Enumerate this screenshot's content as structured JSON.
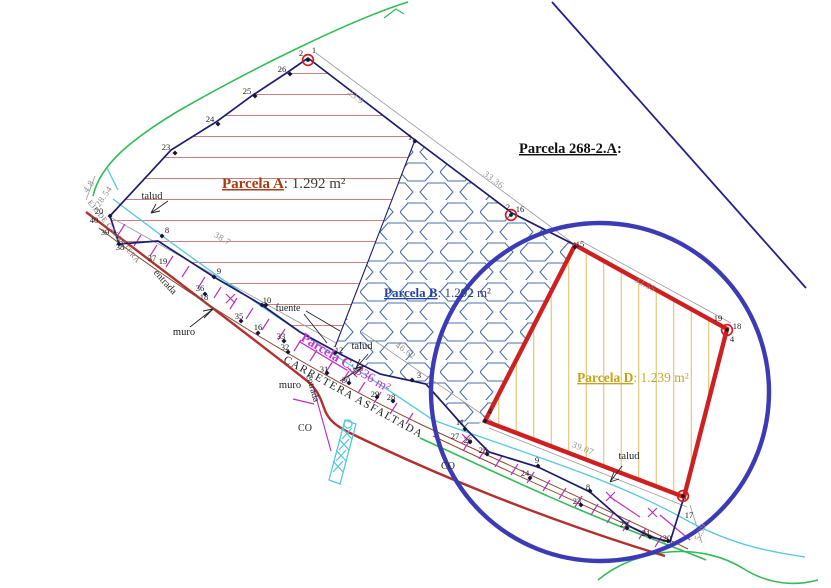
{
  "title": {
    "text": "Parcela 268-2.A",
    "colon": ":"
  },
  "parcels": [
    {
      "label": "Parcela A",
      "sep": ": ",
      "value": "1.292 m²",
      "color": "#a63c14",
      "value_color": "#3a3a3a"
    },
    {
      "label": "Parcela B",
      "sep": ": ",
      "value": "1.292 m²",
      "color": "#2244a0",
      "value_color": "#2b3c77"
    },
    {
      "label": "Parcela C",
      "sep": ": ",
      "value": "336 m²",
      "color": "#cc33cc",
      "value_color": "#cc33cc"
    },
    {
      "label": "Parcela D",
      "sep": ": ",
      "value": "1.239 m²",
      "color": "#c7a317",
      "value_color": "#c3a63a"
    }
  ],
  "colors": {
    "boundary_navy": "#1c1c6e",
    "parcel_d_outline": "#cf2020",
    "circle_blue": "#3b3bb5",
    "hatch_a": "#c98080",
    "hatch_b": "#4a6fa8",
    "hatch_d": "#dfc368",
    "road_red": "#b23030",
    "road_brown": "#8a4a30",
    "talud_cyan": "#55c8dc",
    "slope_magenta": "#bb33bb",
    "contour_green": "#33bb55",
    "dimension_grey": "#8f8f8f"
  },
  "dimensions": [
    {
      "t": "23.9",
      "x": 354,
      "y": 99,
      "a": 37
    },
    {
      "t": "33.36",
      "x": 492,
      "y": 182,
      "a": 37
    },
    {
      "t": "32.55",
      "x": 644,
      "y": 287,
      "a": 28
    },
    {
      "t": "38.7",
      "x": 221,
      "y": 241,
      "a": 31
    },
    {
      "t": "46.62",
      "x": 404,
      "y": 353,
      "a": 34
    },
    {
      "t": "39.07",
      "x": 582,
      "y": 451,
      "a": 22
    },
    {
      "t": "4.8",
      "x": 91,
      "y": 188,
      "a": -55
    },
    {
      "t": "28.54",
      "x": 106,
      "y": 198,
      "a": -55
    },
    {
      "t": "5.39",
      "x": 703,
      "y": 533,
      "a": -68
    }
  ],
  "annotations": [
    {
      "t": "talud",
      "x": 152,
      "y": 199,
      "a": 0,
      "s": 10.5,
      "c": "#222222"
    },
    {
      "t": "talud",
      "x": 362,
      "y": 349,
      "a": 0,
      "s": 10.5,
      "c": "#222222"
    },
    {
      "t": "talud",
      "x": 629,
      "y": 459,
      "a": 0,
      "s": 10.5,
      "c": "#222222"
    },
    {
      "t": "entrada",
      "x": 163,
      "y": 284,
      "a": 48,
      "s": 10,
      "c": "#222222"
    },
    {
      "t": "entrada",
      "x": 310,
      "y": 389,
      "a": 74,
      "s": 9.5,
      "c": "#222222"
    },
    {
      "t": "muro",
      "x": 184,
      "y": 335,
      "a": 0,
      "s": 10.5,
      "c": "#222222"
    },
    {
      "t": "muro",
      "x": 290,
      "y": 388,
      "a": 0,
      "s": 10.5,
      "c": "#222222"
    },
    {
      "t": "CO",
      "x": 305,
      "y": 431,
      "a": 0,
      "s": 10,
      "c": "#222222"
    },
    {
      "t": "CO",
      "x": 448,
      "y": 469,
      "a": 0,
      "s": 10,
      "c": "#222222"
    },
    {
      "t": "fuente",
      "x": 288,
      "y": 311,
      "a": 0,
      "s": 10,
      "c": "#222222"
    },
    {
      "t": "CARRETERA ASFALTADA",
      "x": 352,
      "y": 400,
      "a": 29,
      "s": 11,
      "c": "#222222",
      "ls": 1.5
    },
    {
      "t": "EJE DE CARRETERA",
      "x": 112,
      "y": 233,
      "a": 51,
      "s": 7.5,
      "c": "#777777",
      "ls": 0.5
    }
  ],
  "points": [
    {
      "t": "23",
      "x": 166,
      "y": 150
    },
    {
      "t": "24",
      "x": 210,
      "y": 122
    },
    {
      "t": "25",
      "x": 247,
      "y": 94
    },
    {
      "t": "26",
      "x": 282,
      "y": 72
    },
    {
      "t": "2",
      "x": 301,
      "y": 56
    },
    {
      "t": "1",
      "x": 314,
      "y": 53
    },
    {
      "t": "1",
      "x": 410,
      "y": 140
    },
    {
      "t": "2",
      "x": 508,
      "y": 210
    },
    {
      "t": "16",
      "x": 520,
      "y": 212
    },
    {
      "t": "15",
      "x": 580,
      "y": 247
    },
    {
      "t": "19",
      "x": 718,
      "y": 321
    },
    {
      "t": "18",
      "x": 737,
      "y": 329
    },
    {
      "t": "4",
      "x": 732,
      "y": 342
    },
    {
      "t": "17",
      "x": 689,
      "y": 518
    },
    {
      "t": "20",
      "x": 99,
      "y": 214
    },
    {
      "t": "40",
      "x": 94,
      "y": 223
    },
    {
      "t": "39",
      "x": 105,
      "y": 235
    },
    {
      "t": "38",
      "x": 120,
      "y": 250
    },
    {
      "t": "8",
      "x": 167,
      "y": 233
    },
    {
      "t": "37",
      "x": 152,
      "y": 261
    },
    {
      "t": "19",
      "x": 163,
      "y": 264
    },
    {
      "t": "9",
      "x": 219,
      "y": 274
    },
    {
      "t": "36",
      "x": 200,
      "y": 291
    },
    {
      "t": "18",
      "x": 204,
      "y": 300
    },
    {
      "t": "10",
      "x": 267,
      "y": 303
    },
    {
      "t": "35",
      "x": 239,
      "y": 319
    },
    {
      "t": "16",
      "x": 258,
      "y": 330
    },
    {
      "t": "33",
      "x": 281,
      "y": 339
    },
    {
      "t": "32",
      "x": 285,
      "y": 350
    },
    {
      "t": "12",
      "x": 339,
      "y": 353
    },
    {
      "t": "31",
      "x": 324,
      "y": 372
    },
    {
      "t": "30",
      "x": 346,
      "y": 383
    },
    {
      "t": "29",
      "x": 375,
      "y": 397
    },
    {
      "t": "28",
      "x": 391,
      "y": 400
    },
    {
      "t": "3",
      "x": 419,
      "y": 378
    },
    {
      "t": "11",
      "x": 460,
      "y": 425
    },
    {
      "t": "27",
      "x": 455,
      "y": 439
    },
    {
      "t": "26",
      "x": 468,
      "y": 443
    },
    {
      "t": "4",
      "x": 490,
      "y": 414
    },
    {
      "t": "25",
      "x": 483,
      "y": 453
    },
    {
      "t": "9",
      "x": 537,
      "y": 463
    },
    {
      "t": "24",
      "x": 525,
      "y": 476
    },
    {
      "t": "8",
      "x": 588,
      "y": 490
    },
    {
      "t": "23",
      "x": 577,
      "y": 504
    },
    {
      "t": "22",
      "x": 624,
      "y": 527
    },
    {
      "t": "21",
      "x": 646,
      "y": 536
    },
    {
      "t": "20",
      "x": 667,
      "y": 541
    }
  ],
  "markers": [
    [
      175,
      153
    ],
    [
      218,
      124
    ],
    [
      255,
      96
    ],
    [
      290,
      74
    ],
    [
      415,
      141
    ],
    [
      575,
      247
    ],
    [
      110,
      216
    ],
    [
      119,
      244
    ],
    [
      162,
      236
    ],
    [
      214,
      277
    ],
    [
      262,
      305
    ],
    [
      241,
      321
    ],
    [
      258,
      333
    ],
    [
      284,
      341
    ],
    [
      288,
      352
    ],
    [
      335,
      353
    ],
    [
      327,
      373
    ],
    [
      349,
      383
    ],
    [
      377,
      397
    ],
    [
      393,
      401
    ],
    [
      412,
      380
    ],
    [
      465,
      429
    ],
    [
      470,
      442
    ],
    [
      487,
      454
    ],
    [
      538,
      466
    ],
    [
      530,
      478
    ],
    [
      590,
      491
    ],
    [
      581,
      505
    ],
    [
      627,
      528
    ],
    [
      650,
      537
    ],
    [
      668,
      541
    ],
    [
      485,
      421
    ],
    [
      205,
      294
    ],
    [
      266,
      305
    ]
  ],
  "key_points": [
    [
      308,
      60
    ],
    [
      511,
      215
    ],
    [
      727,
      330
    ],
    [
      683,
      496
    ]
  ]
}
